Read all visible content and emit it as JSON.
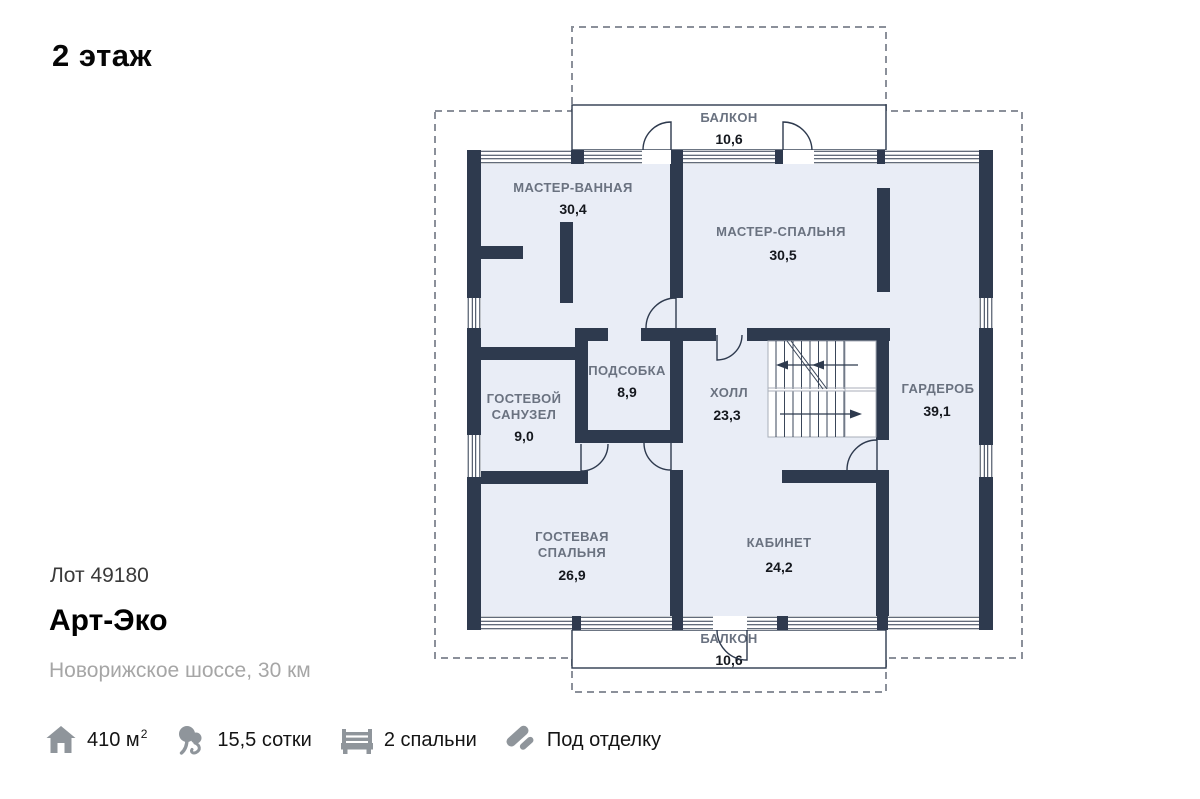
{
  "page": {
    "title": "2 этаж"
  },
  "listing": {
    "lot": "Лот 49180",
    "project_name": "Арт-Эко",
    "location": "Новорижское шоссе, 30 км"
  },
  "features": {
    "area": {
      "icon": "house-icon",
      "value": "410 м",
      "sup": "2"
    },
    "land": {
      "icon": "tree-icon",
      "value": "15,5 сотки"
    },
    "bedrooms": {
      "icon": "bed-icon",
      "value": "2 спальни"
    },
    "finish": {
      "icon": "roller-icon",
      "value": "Под отделку"
    }
  },
  "plan": {
    "balcony_top": {
      "label": "БАЛКОН",
      "area": "10,6"
    },
    "balcony_bottom": {
      "label": "БАЛКОН",
      "area": "10,6"
    },
    "rooms": {
      "master_bath": {
        "label": "МАСТЕР-ВАННАЯ",
        "area": "30,4"
      },
      "master_bedroom": {
        "label": "МАСТЕР-СПАЛЬНЯ",
        "area": "30,5"
      },
      "utility": {
        "label": "ПОДСОБКА",
        "area": "8,9"
      },
      "hall": {
        "label": "ХОЛЛ",
        "area": "23,3"
      },
      "wardrobe": {
        "label": "ГАРДЕРОБ",
        "area": "39,1"
      },
      "guest_wc": {
        "label_line1": "ГОСТЕВОЙ",
        "label_line2": "САНУЗЕЛ",
        "area": "9,0"
      },
      "guest_bedroom": {
        "label_line1": "ГОСТЕВАЯ",
        "label_line2": "СПАЛЬНЯ",
        "area": "26,9"
      },
      "cabinet": {
        "label": "КАБИНЕТ",
        "area": "24,2"
      }
    }
  },
  "colors": {
    "wall": "#2e3a4e",
    "room_fill": "#e9edf6",
    "label_gray": "#6a7280",
    "value_dark": "#15181e",
    "dashed_gray": "#8b909a",
    "icon_gray": "#8f959b"
  }
}
